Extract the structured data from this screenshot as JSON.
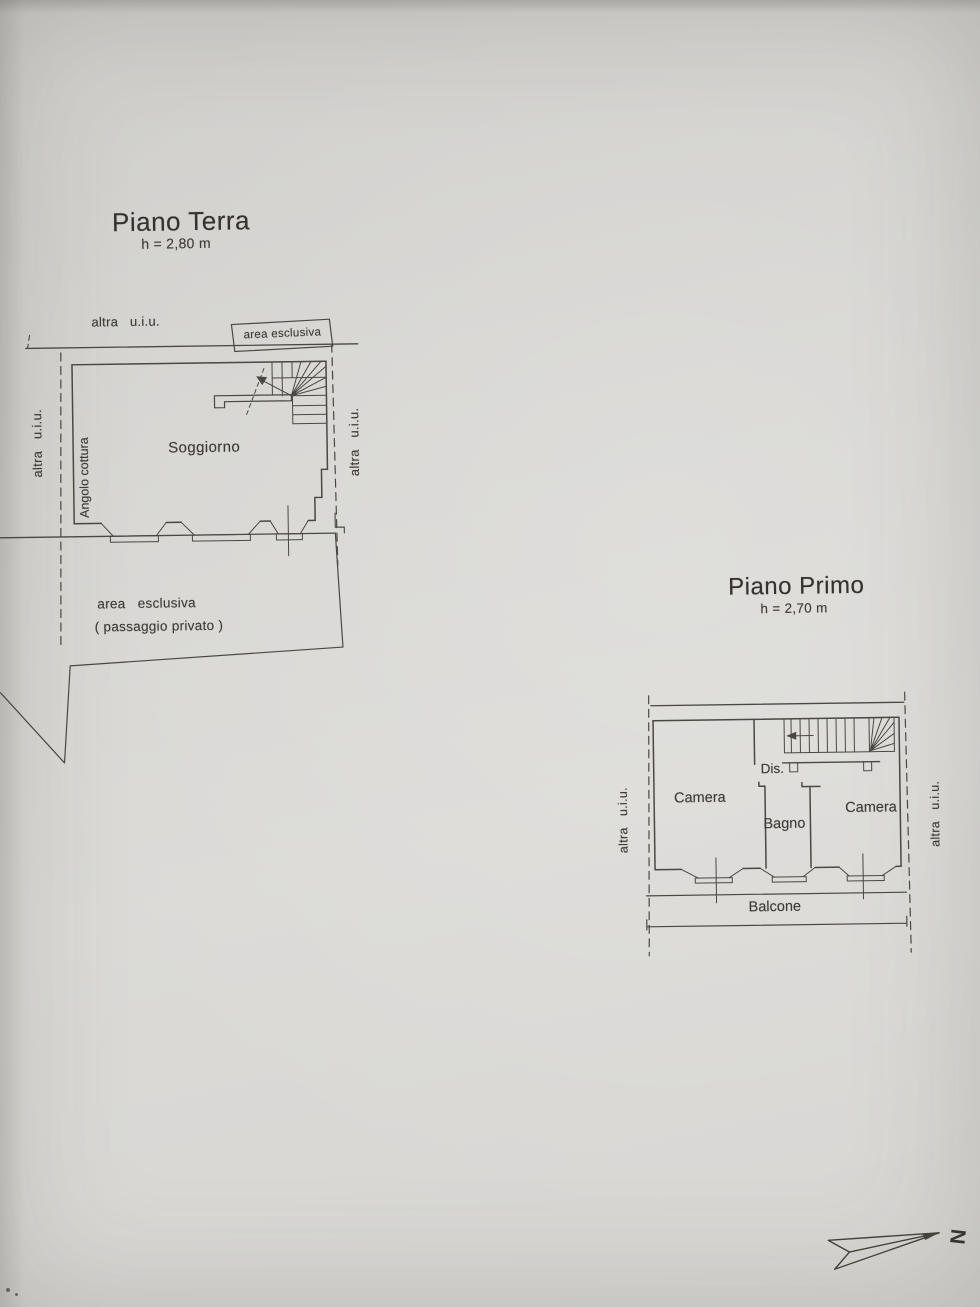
{
  "ground_floor": {
    "title": "Piano Terra",
    "height_label": "h = 2,80 m",
    "boundary_label_top": "altra   u.i.u.",
    "boundary_label_left": "altra   u.i.u.",
    "boundary_label_right": "altra   u.i.u.",
    "exclusive_area_box_label": "area esclusiva",
    "living_room_label": "Soggiorno",
    "kitchen_corner_label": "Angolo cottura",
    "exclusive_area_label": "area   esclusiva",
    "exclusive_area_sublabel": "( passaggio privato )"
  },
  "first_floor": {
    "title": "Piano Primo",
    "height_label": "h = 2,70 m",
    "boundary_label_left": "altra   u.i.u.",
    "boundary_label_right": "altra   u.i.u.",
    "bedroom_left_label": "Camera",
    "bedroom_right_label": "Camera",
    "hallway_label": "Dis.",
    "bathroom_label": "Bagno",
    "balcony_label": "Balcone"
  },
  "compass": {
    "north_label": "N"
  },
  "colors": {
    "paper": "#d6d5d2",
    "ink": "#4b4843"
  }
}
